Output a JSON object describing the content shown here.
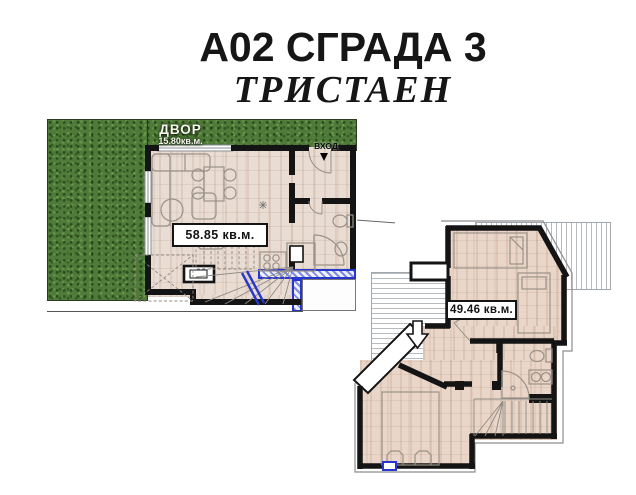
{
  "header": {
    "title": "А02 СГРАДА 3",
    "subtitle": "ТРИСТАЕН"
  },
  "lower_plan": {
    "yard_label": "ДВОР",
    "yard_area": "15.80кв.м.",
    "entrance_label": "ВХОД",
    "area_label": "58.85 кв.м."
  },
  "upper_plan": {
    "area_label": "49.46 кв.м."
  },
  "colors": {
    "text": "#161616",
    "wall": "#141414",
    "grass": "#4f7a39",
    "floor_lower": "#e9dcd2",
    "floor_upper": "#e9d6c8",
    "accent_blue": "#2636cf",
    "hatch_line": "#b6bbc0",
    "furniture_line": "#9a9288"
  }
}
